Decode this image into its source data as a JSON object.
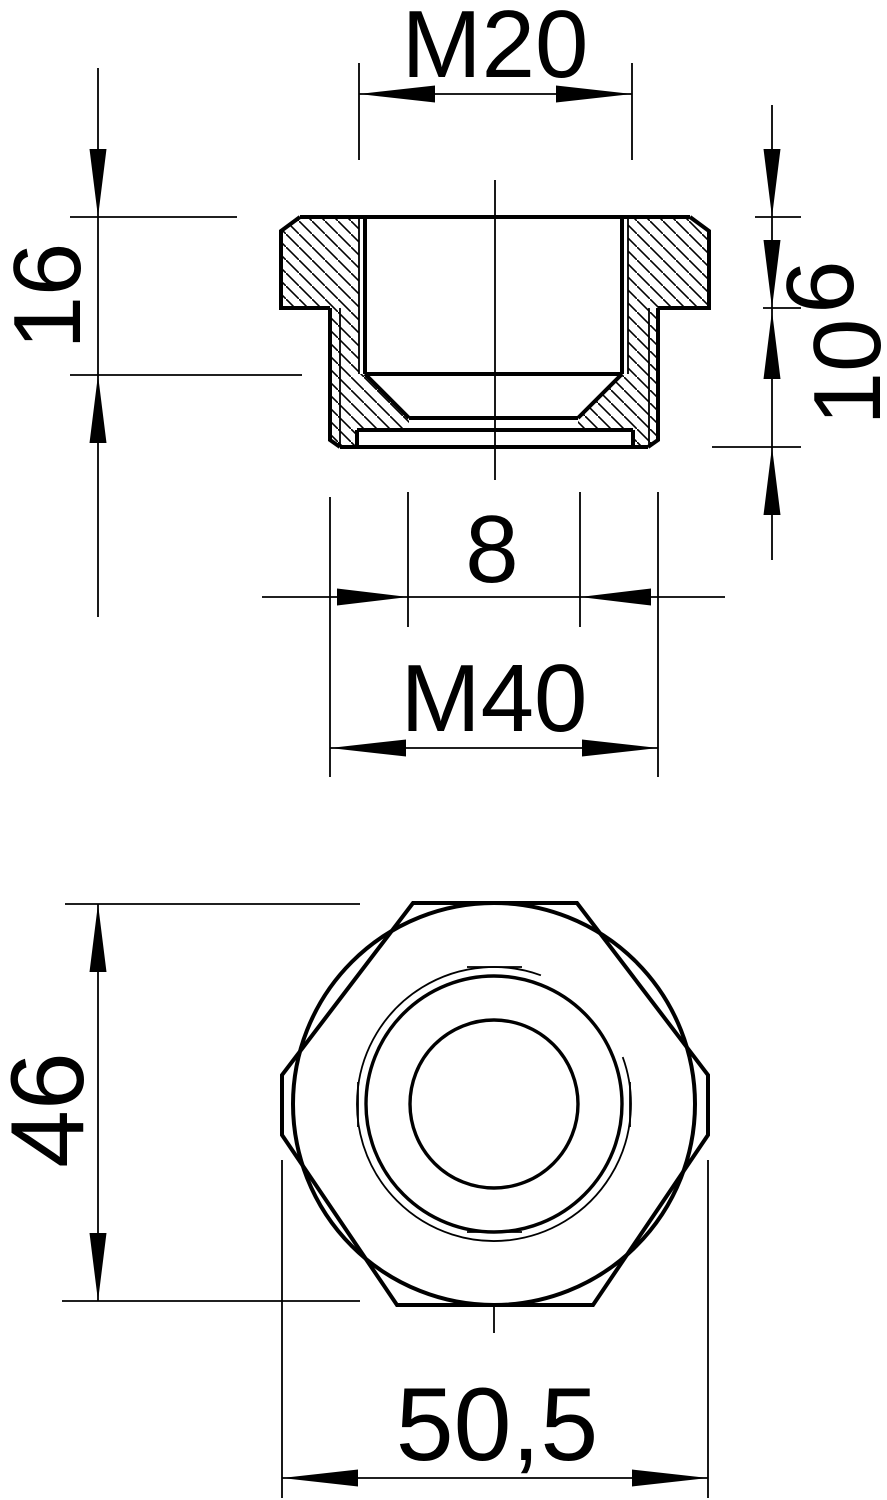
{
  "drawing": {
    "background_color": "#ffffff",
    "line_color": "#000000",
    "views": [
      {
        "id": "section-view",
        "description": "sectional side view of threaded reducer"
      },
      {
        "id": "front-view",
        "description": "front view of hexagonal reducer body"
      }
    ],
    "dimensions": {
      "top_thread": "M20",
      "total_height": "16",
      "head_height": "6",
      "body_height": "10",
      "bottom_opening": "8",
      "body_thread": "M40",
      "across_flats": "46",
      "across_corners": "50,5"
    }
  }
}
